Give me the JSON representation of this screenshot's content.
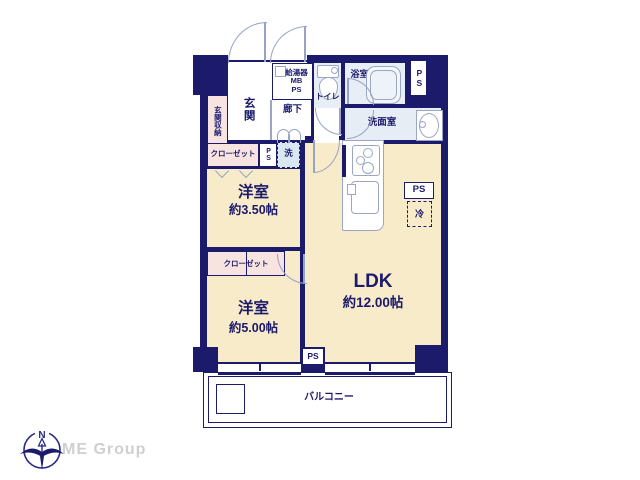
{
  "colors": {
    "wall_navy": "#1c1a6b",
    "floor_cream": "#f8ebca",
    "closet_pink": "#f7e3df",
    "wet_blue": "#e8eef6",
    "washer_blue": "#d9e7f3",
    "fixture_gray": "#9aa6c6",
    "logo_gray": "#cfcfcf"
  },
  "rooms": {
    "entrance": {
      "label": "玄関"
    },
    "entrance_storage": {
      "label": "玄関収納"
    },
    "water_heater": {
      "label": "給湯器\nMB\nPS"
    },
    "hallway": {
      "label": "廊下"
    },
    "toilet": {
      "label": "トイレ"
    },
    "bathroom": {
      "label": "浴室"
    },
    "washroom": {
      "label": "洗面室"
    },
    "washer": {
      "label": "洗"
    },
    "closet_upper": {
      "label": "クローゼット"
    },
    "closet_lower": {
      "label": "クローゼット"
    },
    "bedroom1": {
      "name": "洋室",
      "size": "約3.50帖"
    },
    "bedroom2": {
      "name": "洋室",
      "size": "約5.00帖"
    },
    "ldk": {
      "name": "LDK",
      "size": "約12.00帖"
    },
    "balcony": {
      "label": "バルコニー"
    },
    "fridge": {
      "label": "冷"
    }
  },
  "ps_labels": {
    "top_right": "PS",
    "closet_row": "PS",
    "kitchen": "PS",
    "bottom": "PS"
  },
  "logo": {
    "text": "ME Group",
    "north": "N"
  }
}
